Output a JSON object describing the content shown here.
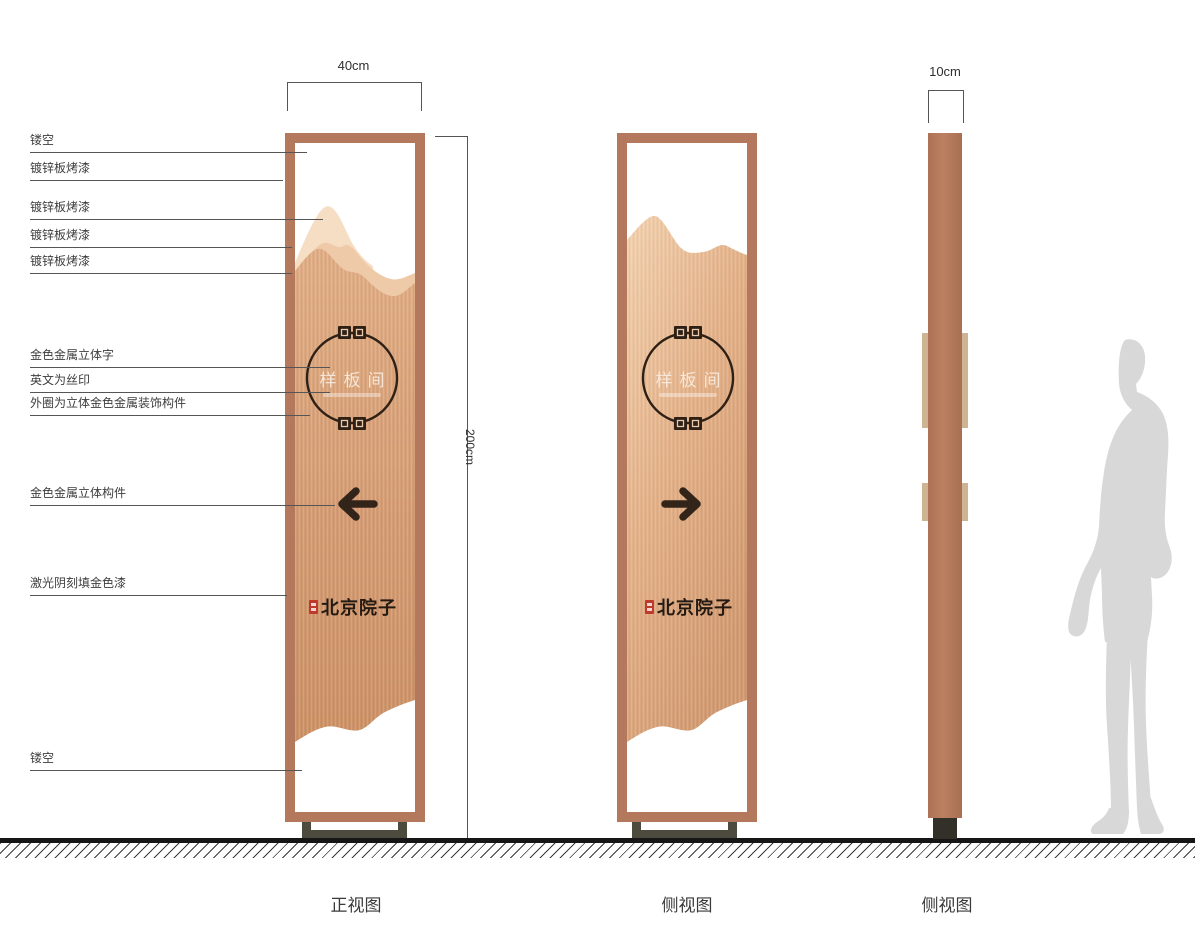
{
  "annotations": [
    {
      "label": "镂空"
    },
    {
      "label": "镀锌板烤漆"
    },
    {
      "label": "镀锌板烤漆"
    },
    {
      "label": "镀锌板烤漆"
    },
    {
      "label": "镀锌板烤漆"
    },
    {
      "label": "金色金属立体字"
    },
    {
      "label": "英文为丝印"
    },
    {
      "label": "外圈为立体金色金属装饰构件"
    },
    {
      "label": "金色金属立体构件"
    },
    {
      "label": "激光阴刻填金色漆"
    },
    {
      "label": "镂空"
    }
  ],
  "dimensions": {
    "front_width": "40cm",
    "total_height": "200cm",
    "side_width": "10cm"
  },
  "panel": {
    "room_name": "样板间",
    "brand_name": "北京院子"
  },
  "captions": {
    "front_view": "正视图",
    "side_view_1": "侧视图",
    "side_view_2": "侧视图"
  },
  "icons": {
    "arrow_left": "left-arrow",
    "arrow_right": "right-arrow",
    "ring_ornament": "fret-ornament",
    "seal": "red-seal-stamp"
  },
  "colors": {
    "frame_copper": "#b4795c",
    "panel_light": "#f2d2b1",
    "panel_dark": "#cb9268",
    "glyph_dark": "#33241a",
    "seal_red": "#bf3a2a",
    "base_gray": "#4c4b3d",
    "silhouette_gray": "#d8d8d8"
  }
}
